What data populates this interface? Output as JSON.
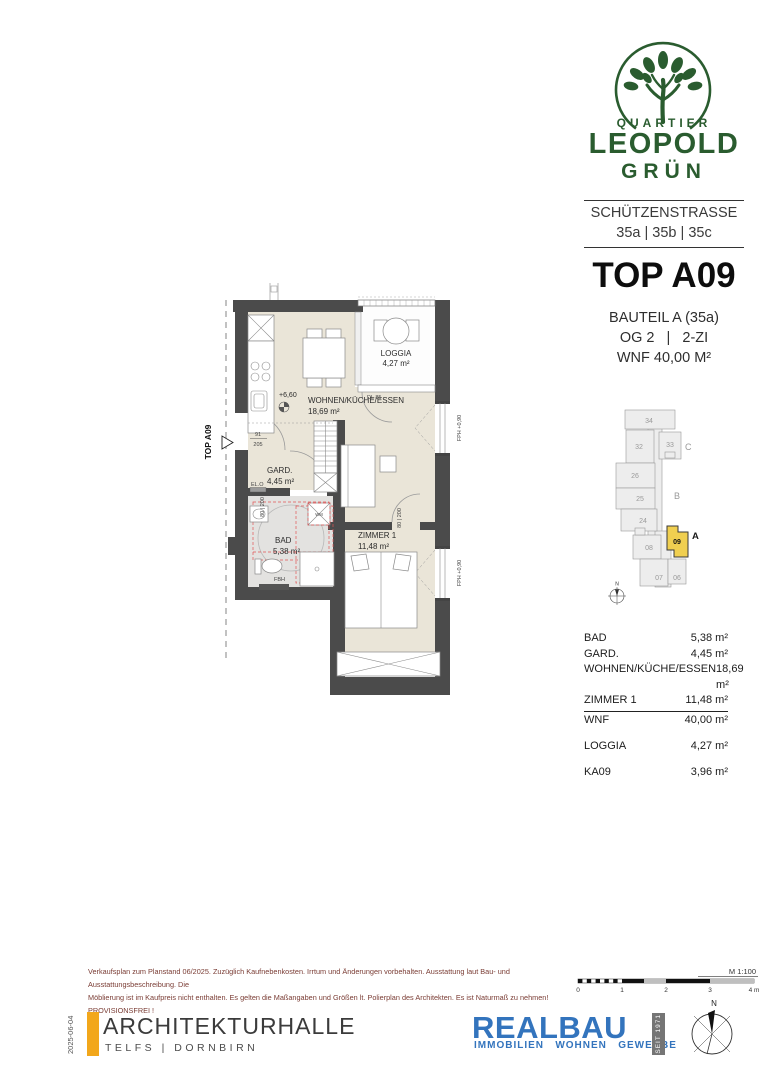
{
  "brand": {
    "name_top": "QUARTIER",
    "name_main": "LEOPOLD",
    "name_sub": "GRÜN",
    "green": "#2a5c2f",
    "address_street": "SCHÜTZENSTRASSE",
    "address_numbers": "35a | 35b | 35c"
  },
  "unit_header": {
    "top_label": "TOP A09",
    "bauteil": "BAUTEIL A (35a)",
    "floor_and_rooms": "OG 2   |   2-ZI",
    "wnf": "WNF 40,00 M²"
  },
  "floorplan": {
    "entrance_label": "TOP A09",
    "level": "+6,60",
    "rooms": {
      "wohnen": {
        "name": "WOHNEN/KÜCHE/ESSEN",
        "area": "18,69 m²"
      },
      "loggia": {
        "name": "LOGGIA",
        "area": "4,27 m²"
      },
      "gard": {
        "name": "GARD.",
        "area": "4,45 m²"
      },
      "bad": {
        "name": "BAD",
        "area": "5,38 m²"
      },
      "zimmer": {
        "name": "ZIMMER 1",
        "area": "11,48 m²"
      }
    },
    "labels": {
      "dl": "DL 85",
      "elo": "EL.O",
      "fbh": "FBH",
      "wm": "WM",
      "fph": "FPH +0,90",
      "door_dim": "80 | 200",
      "entrance_w": "91",
      "entrance_h": "205"
    }
  },
  "siteplan": {
    "units": [
      "34",
      "33",
      "32",
      "26",
      "25",
      "24",
      "08",
      "09",
      "07",
      "06"
    ],
    "highlight_color": "#f0cf50",
    "sections": {
      "c": "C",
      "b": "B",
      "a": "A"
    },
    "north": "N"
  },
  "area_table": {
    "rows": [
      {
        "label": "BAD",
        "value": "5,38 m²"
      },
      {
        "label": "GARD.",
        "value": "4,45 m²"
      },
      {
        "label": "WOHNEN/KÜCHE/ESSEN",
        "value": "18,69 m²"
      },
      {
        "label": "ZIMMER 1",
        "value": "11,48 m²"
      }
    ],
    "total": {
      "label": "WNF",
      "value": "40,00 m²"
    },
    "loggia": {
      "label": "LOGGIA",
      "value": "4,27 m²"
    },
    "ka": {
      "label": "KA09",
      "value": "3,96 m²"
    }
  },
  "footer": {
    "disclaimer_line1": "Verkaufsplan zum Planstand 06/2025. Zuzüglich Kaufnebenkosten. Irrtum und Änderungen vorbehalten. Ausstattung laut Bau- und Ausstattungsbeschreibung. Die",
    "disclaimer_line2": "Möblierung ist im Kaufpreis nicht enthalten. Es gelten die Maßangaben und Größen lt. Polierplan des Architekten. Es ist Naturmaß zu nehmen!   PROVISIONSFREI !",
    "scale": {
      "label": "M 1:100",
      "ticks": [
        "0",
        "1",
        "2",
        "3",
        "4 m"
      ]
    },
    "architect": {
      "date": "2025-06-04",
      "name": "ARCHITEKTURHALLE",
      "locations": "TELFS | DORNBIRN",
      "accent": "#f2a71b"
    },
    "realbau": {
      "name": "REALBAU",
      "tagline": "IMMOBILIEN   WOHNEN   GEWERBE",
      "since": "SEIT 1971",
      "blue": "#3374bd"
    },
    "compass_north": "N"
  }
}
